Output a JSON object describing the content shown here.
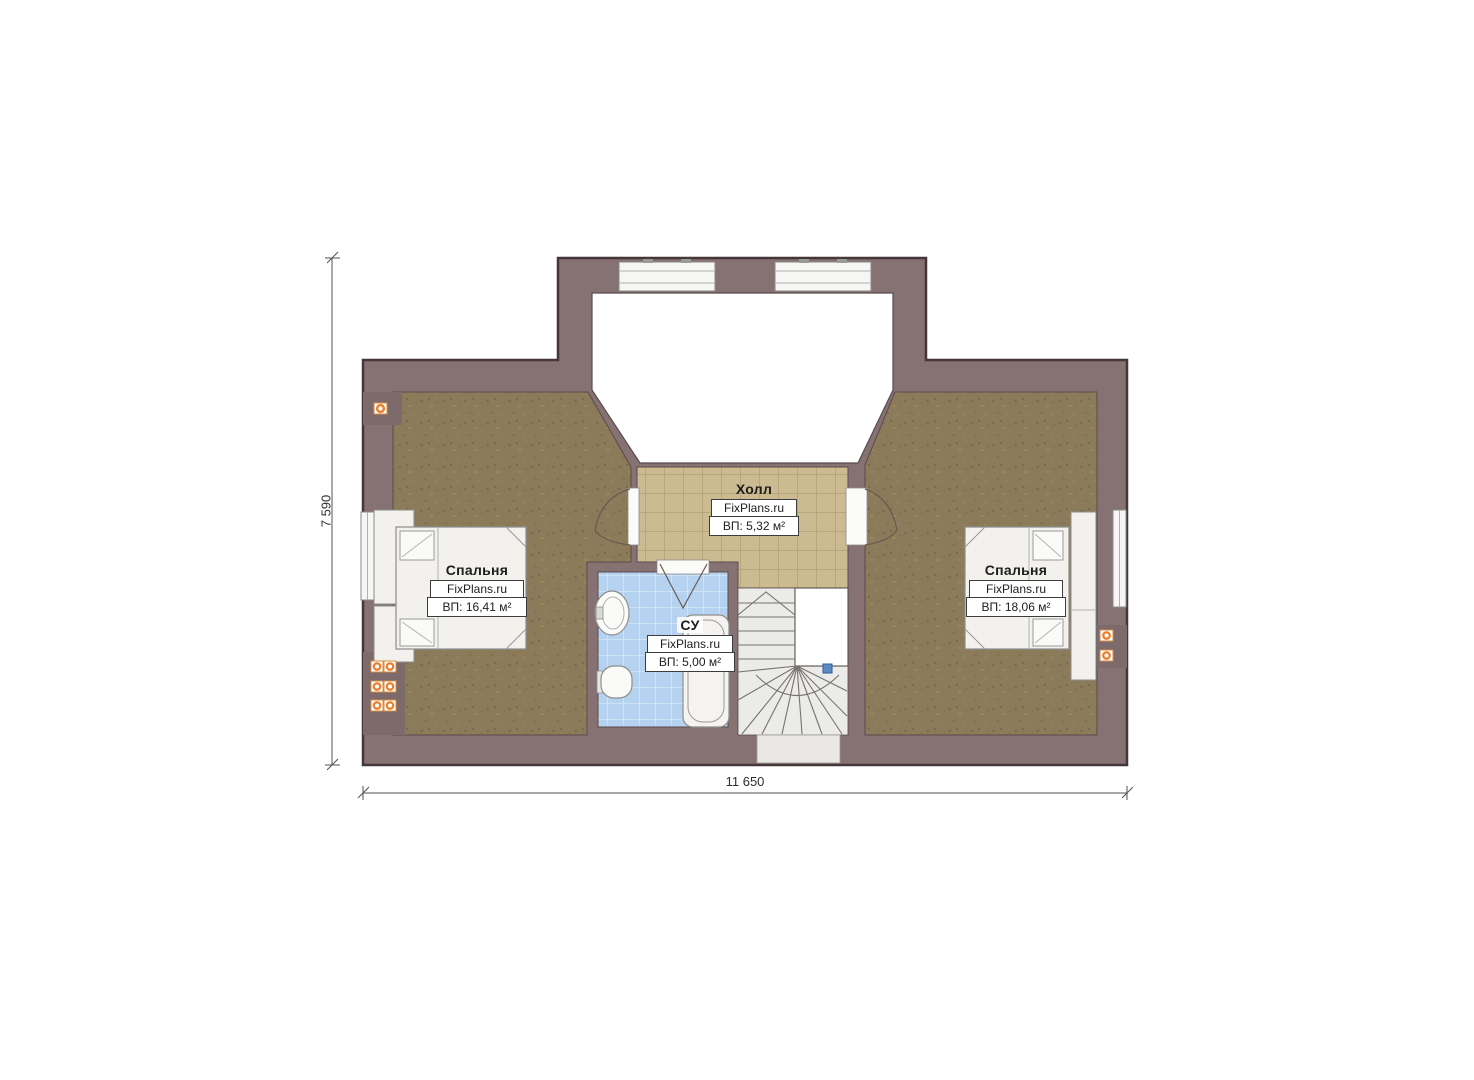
{
  "floor_plan": {
    "type": "attic-floor-plan",
    "rooms": [
      {
        "key": "bedroom-left",
        "name": "Спальня",
        "brand": "FixPlans.ru",
        "area": "ВП: 16,41 м²"
      },
      {
        "key": "hall",
        "name": "Холл",
        "brand": "FixPlans.ru",
        "area": "ВП: 5,32 м²"
      },
      {
        "key": "bathroom",
        "name": "СУ",
        "brand": "FixPlans.ru",
        "area": "ВП: 5,00 м²"
      },
      {
        "key": "bedroom-right",
        "name": "Спальня",
        "brand": "FixPlans.ru",
        "area": "ВП: 18,06 м²"
      }
    ],
    "dimensions": {
      "overall_width_label": "11 650",
      "overall_height_label": "7 590"
    },
    "symbols": [
      "double-bed-symbol",
      "wardrobe-symbol",
      "bathtub-symbol",
      "sink-symbol",
      "toilet-symbol",
      "winder-staircase-symbol",
      "door-swing-symbol",
      "window-symbol",
      "power-outlet-icon",
      "stair-direction-marker"
    ],
    "colors": {
      "wall": "#867173",
      "wall_outline": "#453739",
      "carpet": "#8c7b5a",
      "hall_tile": "#ccba90",
      "hall_tile_line": "#a5926b",
      "bath_tile": "#b5d3f0",
      "bath_tile_line": "#dcebfb",
      "stairs": "#ebebe9",
      "furniture": "#f2f1ee",
      "outlet_orange": "#ea7f2e",
      "marker_blue": "#5b8ac2"
    }
  }
}
